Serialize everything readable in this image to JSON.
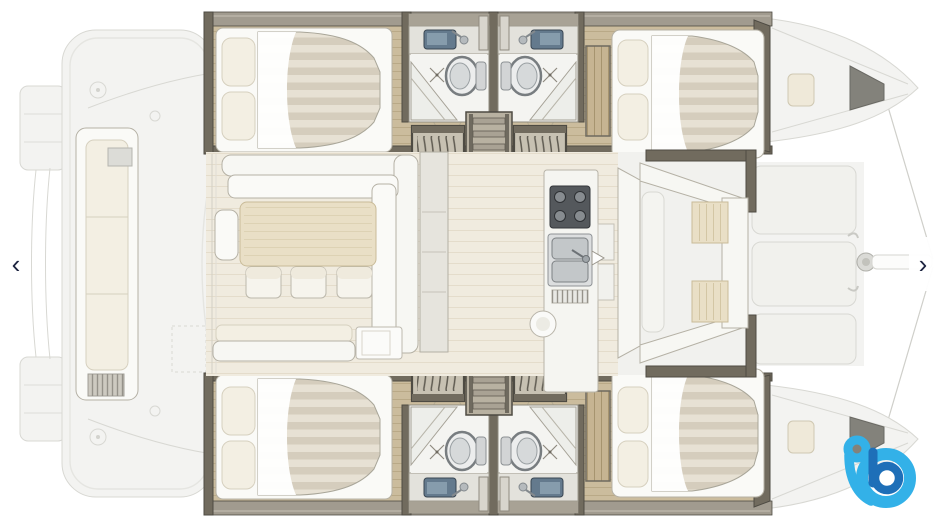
{
  "carousel": {
    "prev_label": "‹",
    "next_label": "›",
    "prev_aria": "Previous image",
    "next_aria": "Next image"
  },
  "floorplan": {
    "description": "Catamaran layout plan, top-down view, bow to the right",
    "areas": [
      "stern swim platforms",
      "aft cockpit with long bench",
      "saloon with L-sofa, dining table and three chairs",
      "galley with stove and double sink",
      "two companionway step hatches and central ladder per hull",
      "upper hull: aft double cabin, two bathrooms with shower and toilet, forward double cabin",
      "lower hull: aft double cabin, two bathrooms with shower and toilet, forward double cabin",
      "forward cockpit with U-seating and two tables",
      "foredeck panels, mast and bowsprit"
    ]
  },
  "logo": {
    "label": "b",
    "aria": "boat logo watermark"
  },
  "palette": {
    "canvas_bg": "#ffffff",
    "faded_fill": "#f3f3f1",
    "faded_line": "#d8d8d3",
    "faded_line2": "#e5e5e1",
    "wall": "#716b5e",
    "wall_dark": "#4e4b43",
    "gunwale": "#a19b8f",
    "wood": "#cbbc9d",
    "wood_line": "#b9a987",
    "white_furn": "#fafaf7",
    "furn_line": "#b5b1a5",
    "cream": "#f3efe3",
    "cream_line": "#d6d0bf",
    "mattress": "#e7e1d4",
    "mattress_stripe": "#d5cdbd",
    "saloon_floor": "#f0ebdf",
    "saloon_line": "#e4dccb",
    "table_wood": "#e9dfc6",
    "table_line": "#c9bb98",
    "bath_floor": "#f4f4f1",
    "fixture": "#d8dadb",
    "fixture_dark": "#8e9296",
    "sink_navy": "#647a8d",
    "stove": "#54585c",
    "steel": "#c3c7c9",
    "step_fill": "#c7c1b2",
    "arc_line": "#5f5b51",
    "cockpit_floor": "#f1f1ee",
    "arrow": "#1d2440",
    "pill": "rgba(255,255,255,0.95)",
    "logo_light": "#33b1e8",
    "logo_dark": "#1e6fb8"
  }
}
